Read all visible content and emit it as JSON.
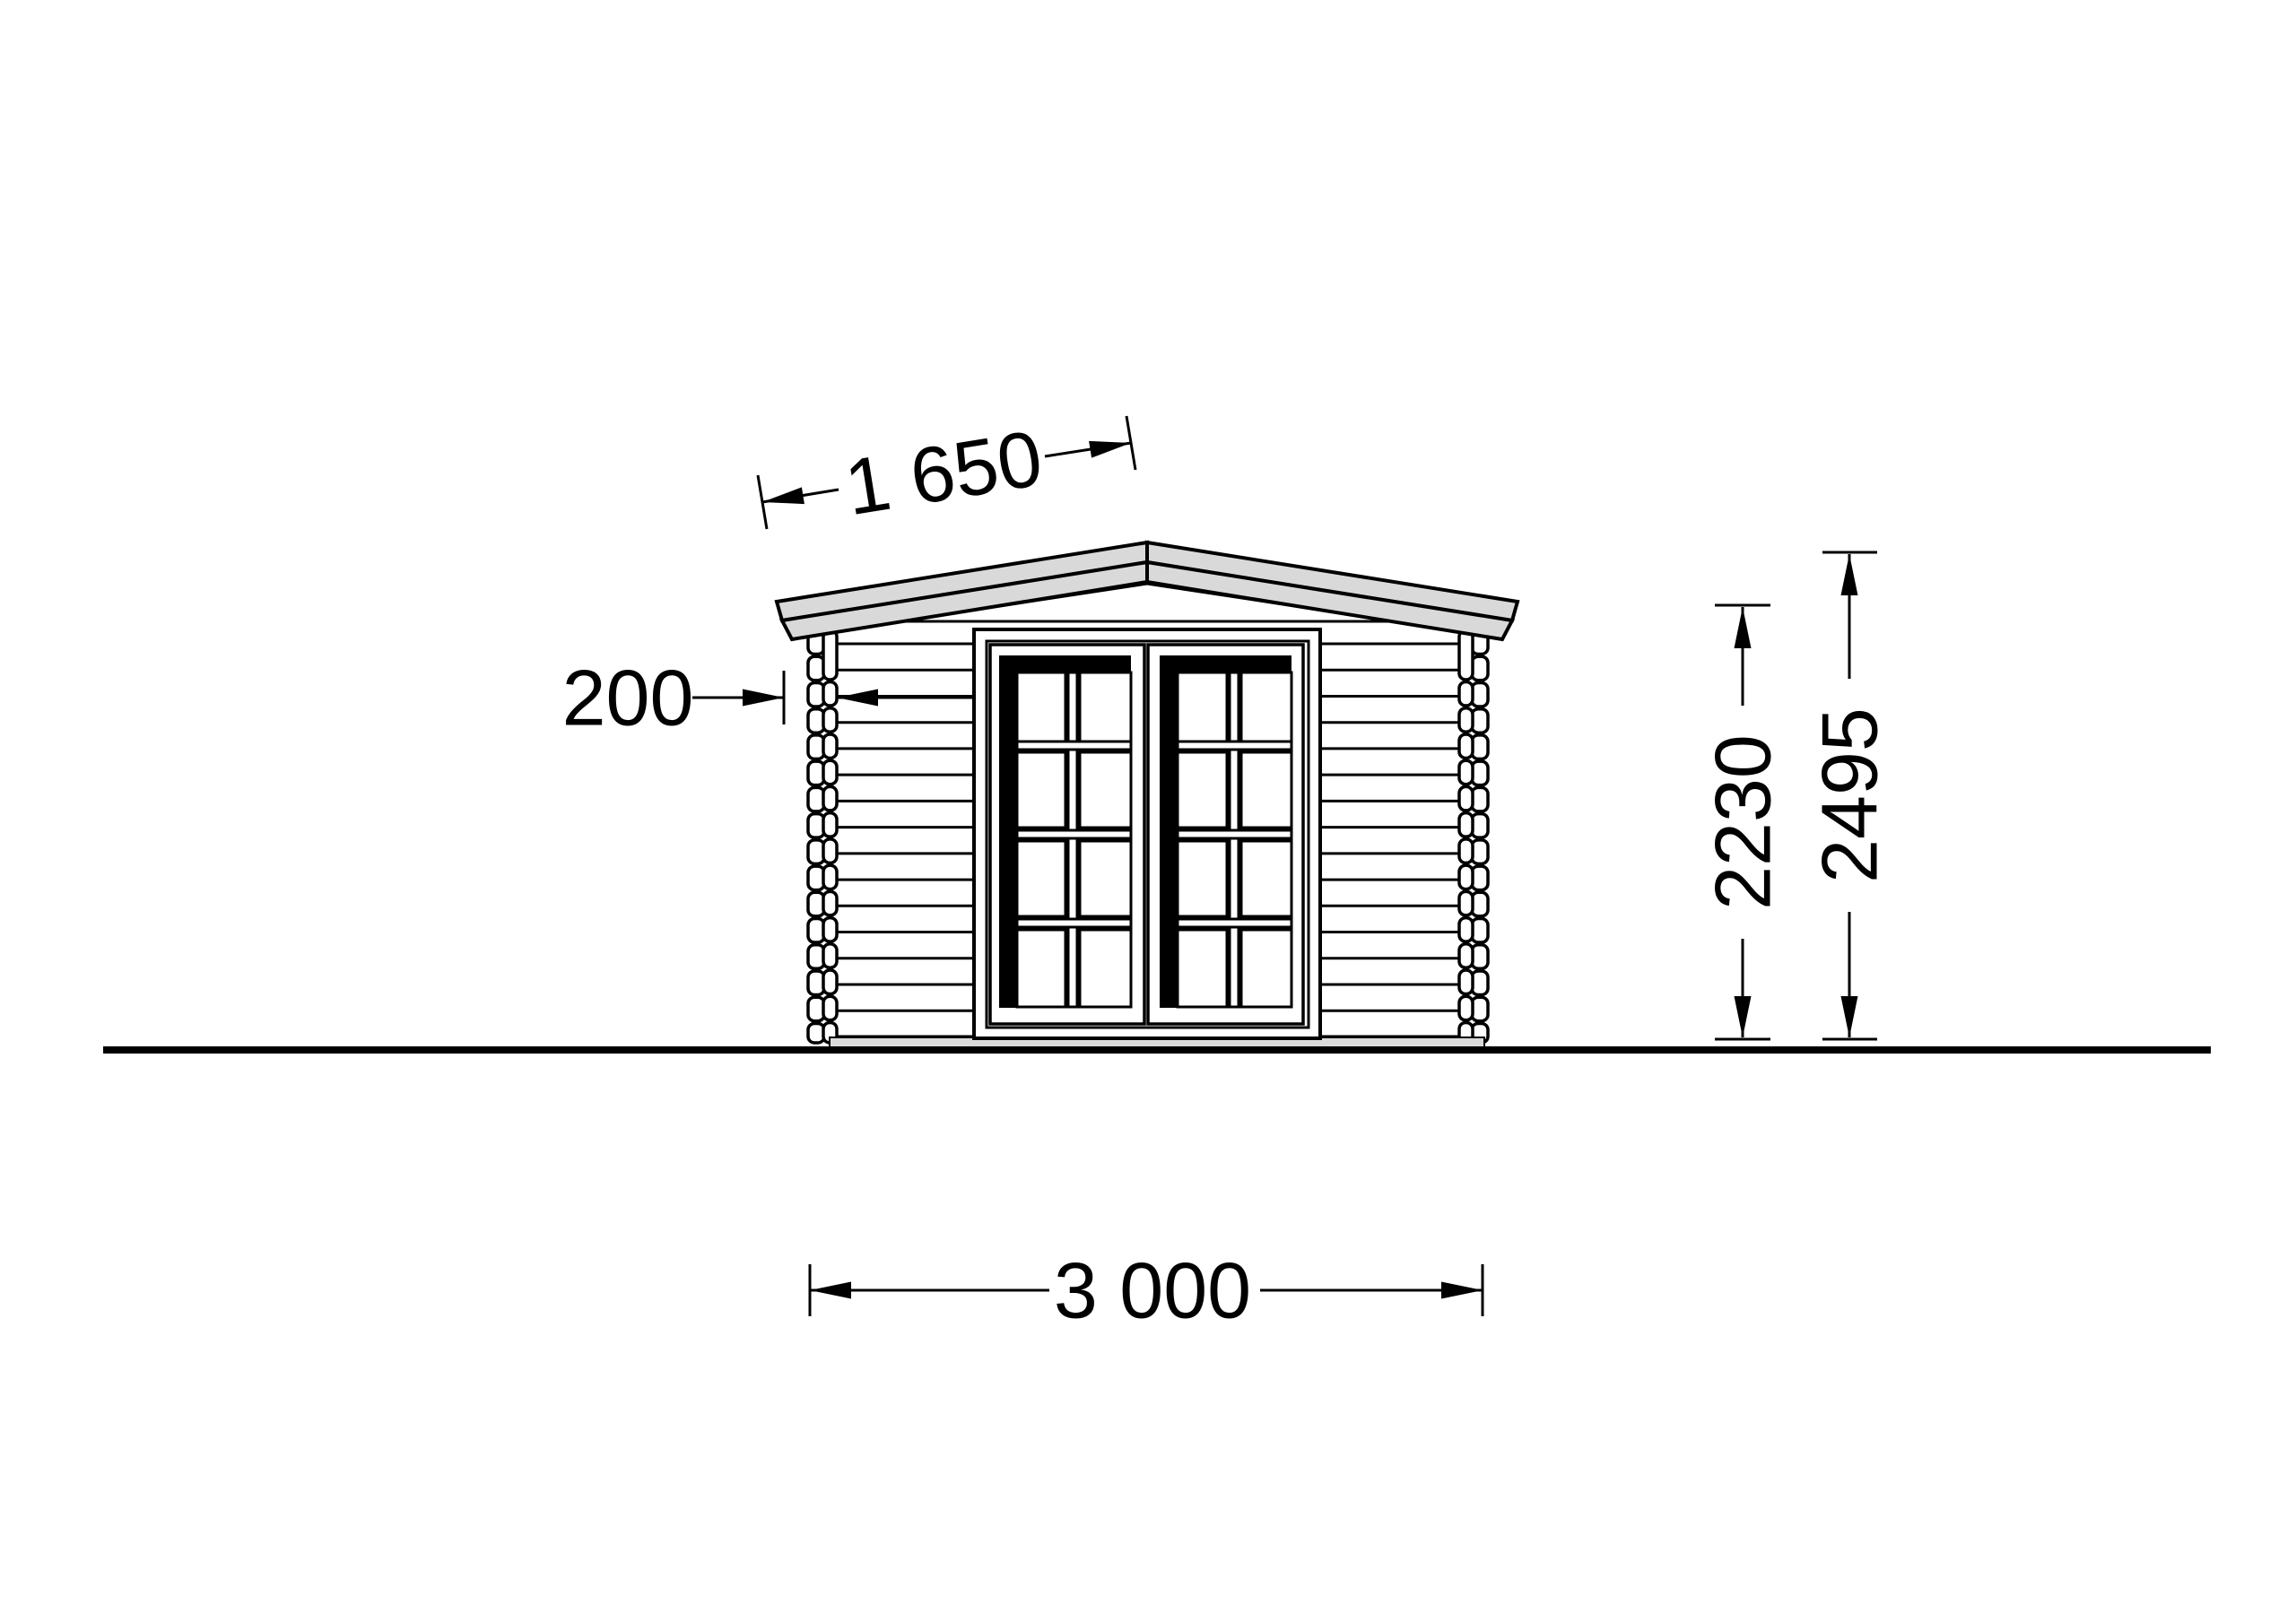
{
  "drawing": {
    "view": "log cabin front elevation",
    "dimensions": {
      "roof_slope": "1 650",
      "roof_overhang": "200",
      "wall_height": "2230",
      "ridge_height": "2495",
      "total_width": "3 000"
    }
  },
  "colors": {
    "line": "#000000",
    "roof_fill": "#d9d9d9",
    "foundation_fill": "#d9d9d9",
    "bg": "#ffffff"
  }
}
